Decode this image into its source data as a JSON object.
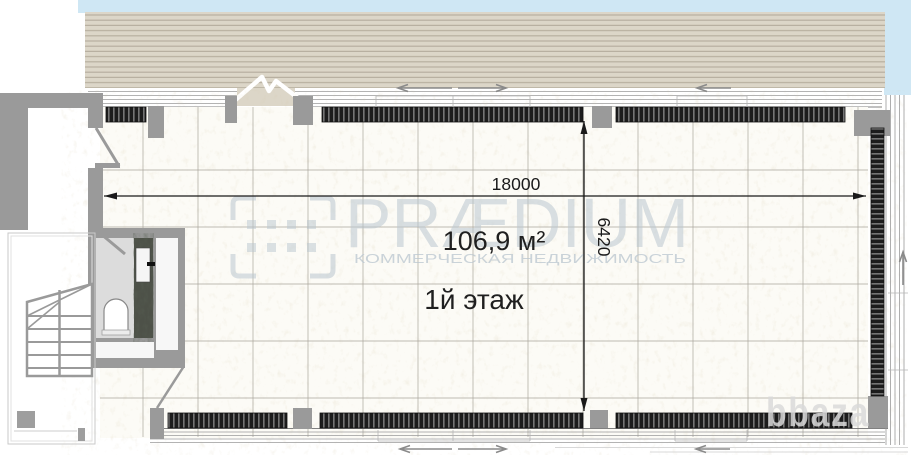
{
  "plan": {
    "floor_label": "1й этаж",
    "area_label": "106,9 м²",
    "dimensions": {
      "width_mm": "18000",
      "depth_mm": "6420"
    }
  },
  "watermarks": {
    "brand": "PRÆDIUM",
    "brand_tagline": "КОММЕРЧЕСКАЯ НЕДВИЖИМОСТЬ",
    "listing_site": "bbaza"
  },
  "icons": {
    "logo_mark": "praedium-qr-icon",
    "door_zigzag": "entrance-break-icon",
    "sliding_arrows": "sliding-window-arrow-icon"
  },
  "colors": {
    "wall_gray": "#9a9a9a",
    "deck_beige": "#dcd6c8",
    "sky_blue": "#cfe7f4",
    "radiator_dark": "#1c1c1c",
    "watermark_blue_gray": "#b9c6cf",
    "dimension_ink": "#1a1a1a"
  }
}
